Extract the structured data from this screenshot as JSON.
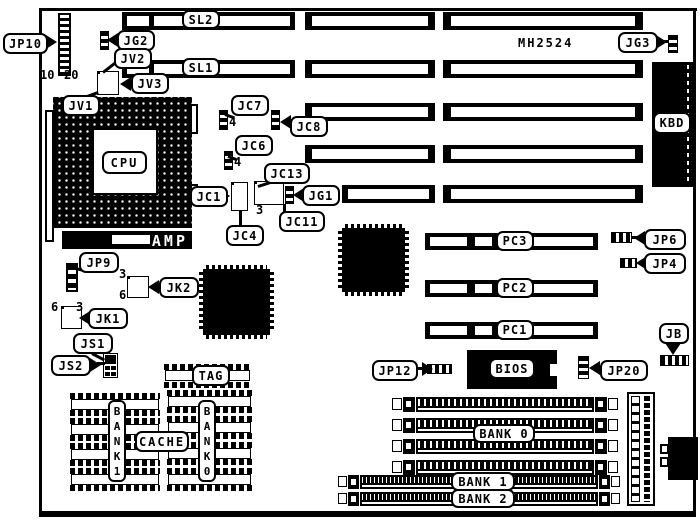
{
  "board": {
    "model": "MH2524"
  },
  "chips": {
    "cpu": "CPU",
    "amp": "AMP",
    "bios": "BIOS",
    "kbd": "KBD",
    "tag": "TAG",
    "cache": "CACHE"
  },
  "slots": {
    "sl1": "SL1",
    "sl2": "SL2",
    "pc1": "PC1",
    "pc2": "PC2",
    "pc3": "PC3"
  },
  "memory": {
    "bank0": "BANK 0",
    "bank1": "BANK 1",
    "bank2": "BANK 2",
    "cache_bank1_col": "BANK1",
    "cache_bank0_col": "BANK0"
  },
  "jumpers": {
    "jp10": "JP10",
    "jg2": "JG2",
    "jg3": "JG3",
    "jv1": "JV1",
    "jv2": "JV2",
    "jv3": "JV3",
    "jc1": "JC1",
    "jc4": "JC4",
    "jc6": "JC6",
    "jc7": "JC7",
    "jc8": "JC8",
    "jc11": "JC11",
    "jc13": "JC13",
    "jg1": "JG1",
    "jp9": "JP9",
    "jk1": "JK1",
    "jk2": "JK2",
    "js1": "JS1",
    "js2": "JS2",
    "jp12": "JP12",
    "jp20": "JP20",
    "jp6": "JP6",
    "jp4": "JP4",
    "jb": "JB"
  },
  "pins": {
    "jp10_first": "10",
    "jp10_last": "20",
    "jc7_pin": "4",
    "jc6_pin": "4",
    "jc13_pin": "3",
    "jk2_top": "3",
    "jk2_bottom": "6",
    "jk1_left": "6",
    "jk1_right": "3"
  }
}
